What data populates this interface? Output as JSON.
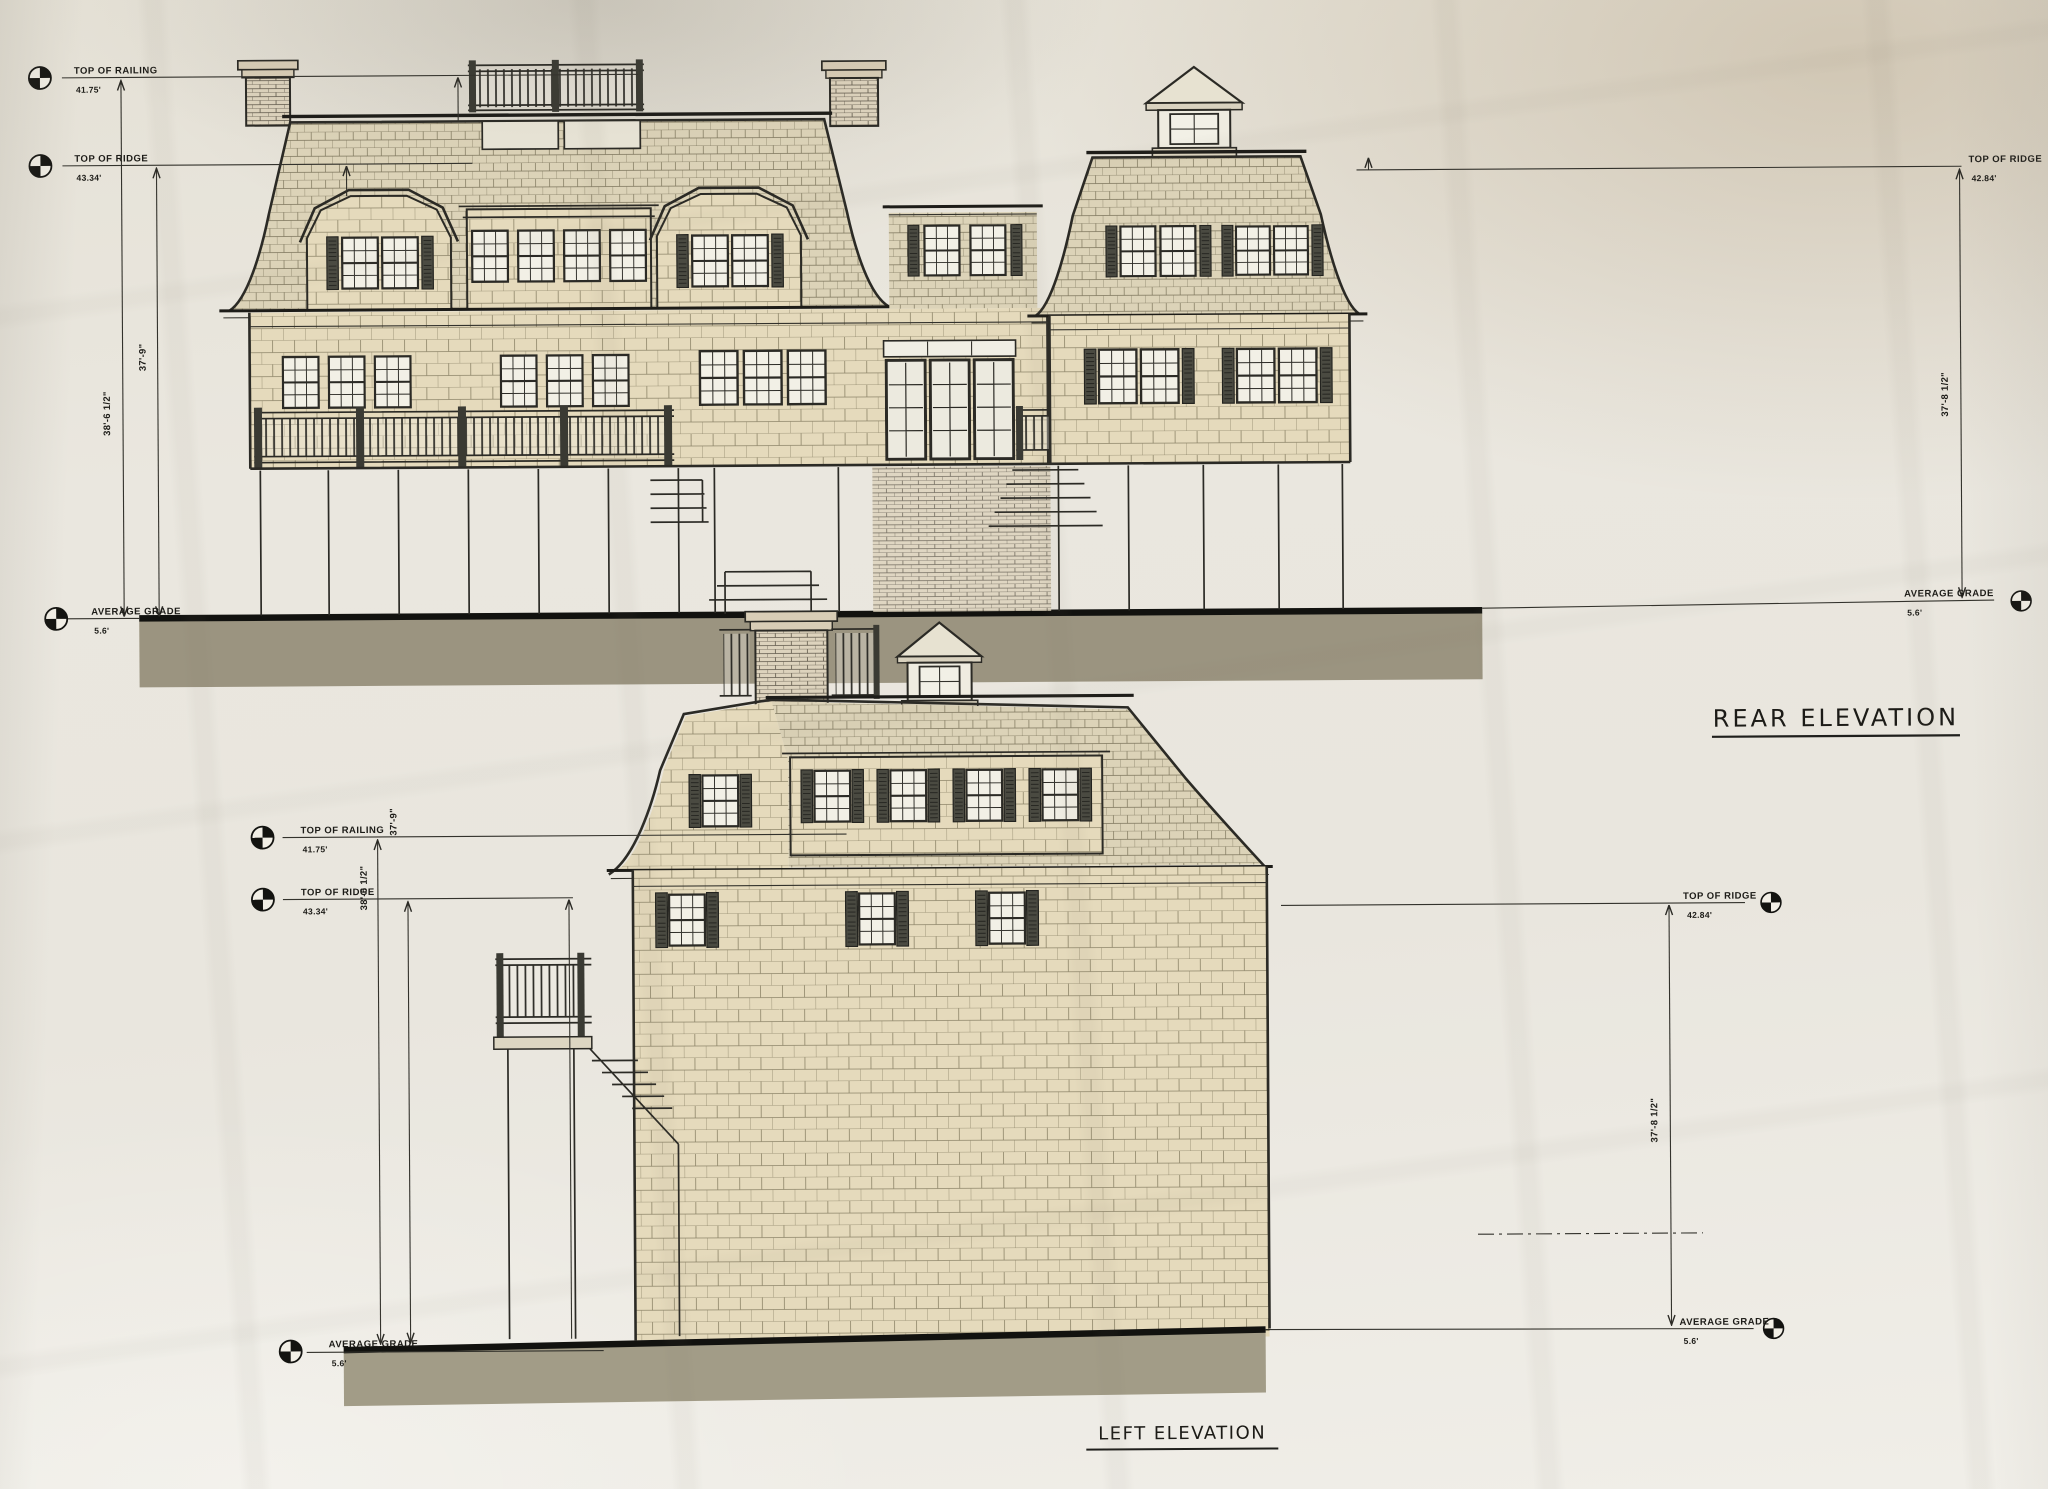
{
  "drawings": {
    "rear": {
      "title": "REAR ELEVATION",
      "levels": {
        "railing": {
          "label": "TOP OF RAILING",
          "value": "41.75'"
        },
        "ridge_left": {
          "label": "TOP OF RIDGE",
          "value": "43.34'"
        },
        "grade_left": {
          "label": "AVERAGE GRADE",
          "value": "5.6'"
        },
        "ridge_right": {
          "label": "TOP OF RIDGE",
          "value": "42.84'"
        },
        "grade_right": {
          "label": "AVERAGE GRADE",
          "value": "5.6'"
        }
      },
      "dimensions": {
        "railing_height": "38'-6 1/2\"",
        "ridge_height": "37'-9\"",
        "ridge_height_right": "37'-8 1/2\""
      }
    },
    "left": {
      "title": "LEFT ELEVATION",
      "levels": {
        "railing": {
          "label": "TOP OF RAILING",
          "value": "41.75'"
        },
        "ridge_left": {
          "label": "TOP OF RIDGE",
          "value": "43.34'"
        },
        "grade_left": {
          "label": "AVERAGE GRADE",
          "value": "5.6'"
        },
        "ridge_right": {
          "label": "TOP OF RIDGE",
          "value": "42.84'"
        },
        "grade_right": {
          "label": "AVERAGE GRADE",
          "value": "5.6'"
        }
      },
      "dimensions": {
        "railing_height": "38'-6 1/2\"",
        "ridge_height": "37'-9\"",
        "ridge_height_right": "37'-8 1/2\""
      }
    }
  },
  "colors": {
    "paper": "#e9e6de",
    "ink": "#2b2a25",
    "wall_shingles": "#e5dabc",
    "roof_shingles": "#dcd3b8",
    "ground": "#9b9480",
    "shutters": "#4a4a41"
  }
}
